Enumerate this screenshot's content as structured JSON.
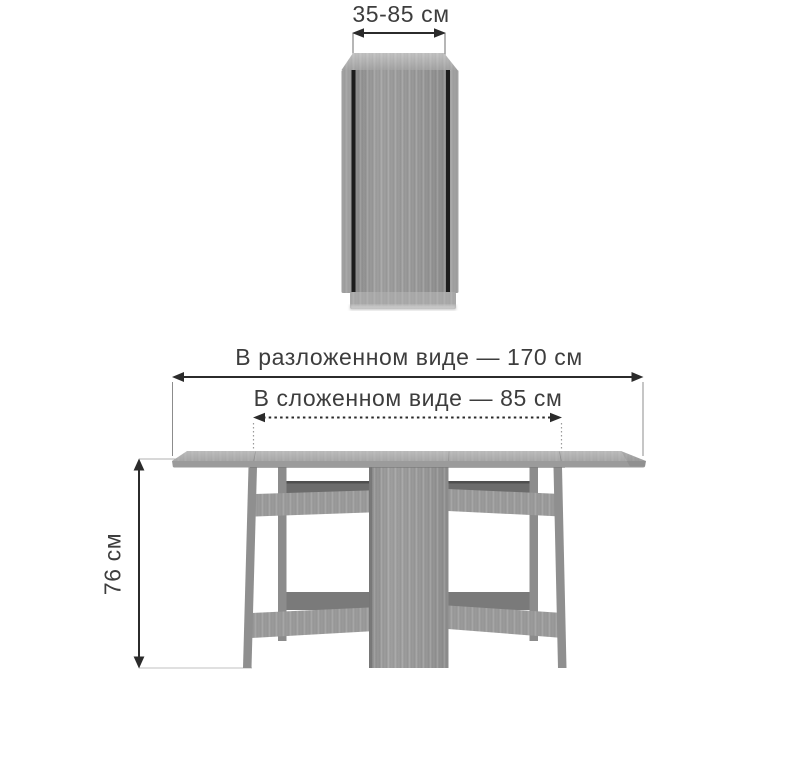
{
  "diagram": {
    "type": "furniture-dimension-diagram",
    "subject": "folding gateleg table, folded front view (top) and unfolded front view (bottom)",
    "labels": {
      "folded_width": "35-85 см",
      "unfolded_length": "В разложенном виде — 170 см",
      "folded_length": "В сложенном виде — 85 см",
      "height": "76 см"
    },
    "values": {
      "width_folded_cm": "35-85",
      "length_unfolded_cm": 170,
      "length_folded_cm": 85,
      "height_cm": 76
    },
    "colors": {
      "background": "#ffffff",
      "wood_mid": "#9d9d9d",
      "wood_light": "#b9b9b9",
      "wood_dark": "#6e6e6e",
      "gap_dark": "#1d1d1d",
      "dimension_line": "#2b2b2b",
      "text": "#3d3d3d"
    }
  }
}
